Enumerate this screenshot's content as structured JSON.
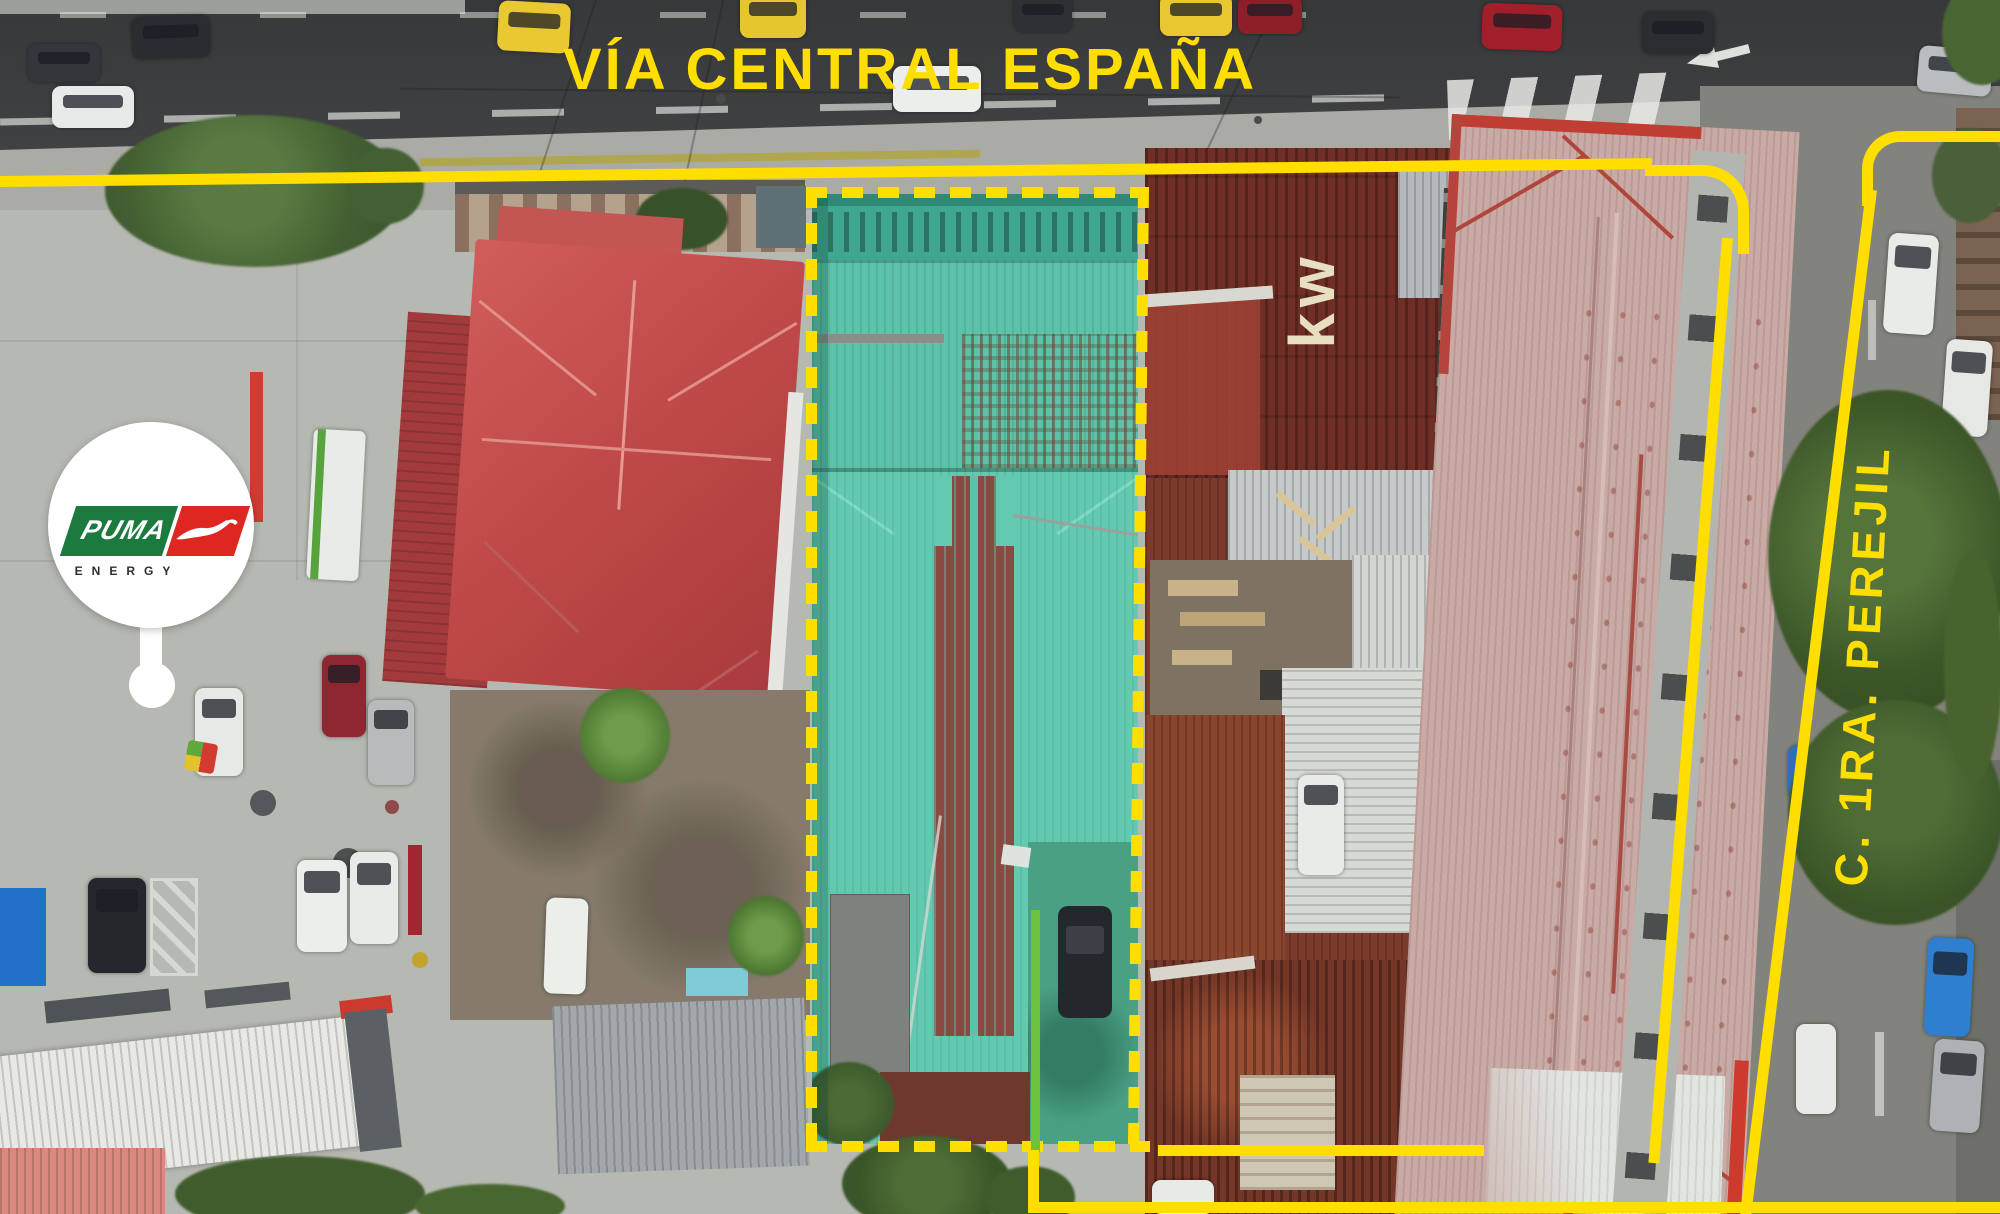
{
  "road": {
    "label": "VÍA CENTRAL ESPAÑA"
  },
  "side_street": {
    "label": "C. 1RA. PEREJIL"
  },
  "roof_marking": {
    "text": "kw"
  },
  "logo": {
    "brand": "PUMA",
    "subtitle": "ENERGY"
  },
  "colors": {
    "annotation_yellow": "#FFDE00",
    "highlight_teal": "#5CC3AA",
    "divider_green": "#6CC43C",
    "logo_green": "#1B7A3E",
    "logo_red": "#DF2721"
  }
}
